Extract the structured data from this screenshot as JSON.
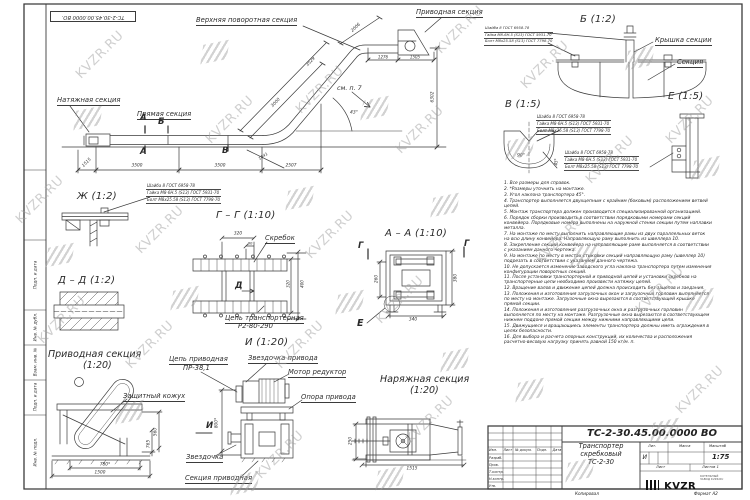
{
  "watermark": {
    "text": "KVZR.RU"
  },
  "stamp_top": "ТС-2-30.45.00.0000 ВО.",
  "main": {
    "labels": {
      "tension_section": "Натяжная секция",
      "straight_section": "Прямая секция",
      "upper_turn_section": "Верхняя поворотная секция",
      "drive_section": "Приводная секция",
      "see_note": "см. п. 7"
    },
    "markers": {
      "a": "А",
      "b": "Б",
      "v": "В"
    },
    "dims": {
      "d1515": "1515",
      "d3500a": "3500",
      "d3500b": "3500",
      "d2507": "2507",
      "d3000": "3000",
      "d3529": "3529",
      "d2006": "2006",
      "d1841": "1841",
      "d1276": "1276",
      "d1505": "1505",
      "d6302": "6302",
      "angle": "43°"
    }
  },
  "hardware": [
    "Шайба 8 ГОСТ 6958-78",
    "Гайка М8-6Н.5 (S13) ГОСТ 5931-70",
    "Болт М8х25.58 (S13) ГОСТ 7798-70"
  ],
  "views": {
    "b": {
      "title": "Б (1:2)",
      "cover": "Крышка секции",
      "section": "Секция"
    },
    "v": {
      "title": "В (1:5)",
      "angle": "90°",
      "dim45": "45*"
    },
    "e": {
      "title": "Е (1:5)"
    },
    "zh": {
      "title": "Ж (1:2)"
    },
    "dd": {
      "title": "Д – Д (1:2)"
    },
    "gg": {
      "title": "Г – Г (1:10)",
      "scraper": "Скребок",
      "chain_label": "Цепь транспортерная",
      "chain_model": "Р2-80-290",
      "marker": "Д",
      "dims": {
        "d320": "320",
        "d80": "80",
        "d320r": "320",
        "d400": "400"
      }
    },
    "aa": {
      "title": "А – А (1:10)",
      "marker_g": "Г",
      "marker_e": "Е",
      "dims": {
        "d260": "260",
        "d380": "380",
        "d340": "340"
      }
    },
    "drive": {
      "title": "Приводная секция",
      "scale": "(1:20)",
      "cover": "Защитный кожух",
      "marker_i": "И",
      "dims": {
        "d560": "560",
        "d765": "765",
        "d780": "780*",
        "d1500": "1500"
      }
    },
    "i": {
      "title": "И (1:20)",
      "sprocket_drive": "Звездочка привода",
      "motor": "Мотор редуктор",
      "support": "Опора привода",
      "chain_label": "Цепь приводная",
      "chain_model": "ПР-38,1",
      "sprocket": "Звездочка",
      "section": "Секция приводная",
      "dims": {
        "d800": "800*"
      }
    },
    "tension": {
      "title": "Наряжная секция",
      "scale": "(1:20)",
      "dims": {
        "d250": "250",
        "d1515": "1515"
      }
    }
  },
  "notes": [
    "1. Все размеры для справок.",
    "2. *Размеры уточнить на монтаже.",
    "3. Угол наклона транспортера 45°.",
    "4. Транспортер выполняется двухцепным с крайним (боковым) расположением ветвей цепей.",
    "5. Монтаж транспортера должен производится специализированной организацией.",
    "6. Порядок сборки производить в соответствии порядковыми номерами секций конвейера. Порядковые номера выполнены на наружной стенки секции путем наплавки металла.",
    "7. На монтаже по месту выполнить направляющие рамы из двух параллельных веток на всю длину конвейера. Направляющую раму выполнить из швеллера 10.",
    "8. Закрепление секций конвейера на направляющие раме выполняется в соответствии с указанием данного чертежа.",
    "9. На монтаже по месту в местах стыковки секций направляющую раму (швеллер 10) подрезать в соответствии с указанием данного чертежа.",
    "10. Не допускается изменение заводского угла наклона транспортера путем изменения конфигурации поворотных секций.",
    "11. После установки транспортерной и приводной цепей и установки скребков на транспортерные цепи необходимо произвести натяжку цепей.",
    "12. Вращение валов и движение цепей должна происходить без зацепов и заедания.",
    "13. Положения и изготовления загрузочных окон и загрузочных горловин выполняется по месту на монтаже. Загрузочные окна вырезаются в соответствующей крышке прямой секции.",
    "14. Положения и изготовления разгрузочных окна и разгрузочных горловин выполняется по месту на монтаже. Разгрузочные окна вырезаются в соответствующем нижнем поддоне прямой секции между нижними направляющими цепи.",
    "15. Движущиеся и вращающиесь элементы транспортера должны иметь ограждения в целях безопасности.",
    "16. Для выбора и расчета опорных конструкций, их количества и расположения расчетно-весовую нагрузку принять равной 150 кг/м. п."
  ],
  "frame": {
    "left_labels": [
      "Подп. и дата",
      "Инв. № дубл.",
      "Взам. инв. №",
      "Подп. и дата",
      "Инв. № подл."
    ]
  },
  "title_block": {
    "doc_number": "ТС-2-30.45.00.0000 ВО",
    "name_line1": "Транспортер",
    "name_line2": "скребковый",
    "name_line3": "ТС-2-30",
    "col_izm": "Изм.",
    "col_list": "Лист",
    "col_doc": "№ докум.",
    "col_podp": "Подп.",
    "col_data": "Дата",
    "row_razrab": "Разраб.",
    "row_prov": "Пров.",
    "row_tkontr": "Т.контр.",
    "row_nkontr": "Н.контр.",
    "row_utv": "Утв.",
    "lit_label": "Лит.",
    "lit_value": "И",
    "mass_label": "Масса",
    "scale_label": "Масштаб",
    "scale_value": "1:75",
    "sheet_label": "Лист",
    "sheets_label": "Листов 1",
    "logo_text": "KVZR",
    "logo_sub1": "КОТЕЛЬНЫЙ",
    "logo_sub2": "ЗАВОД KVZR.RU",
    "copied": "Копировал",
    "format": "Формат А2"
  }
}
